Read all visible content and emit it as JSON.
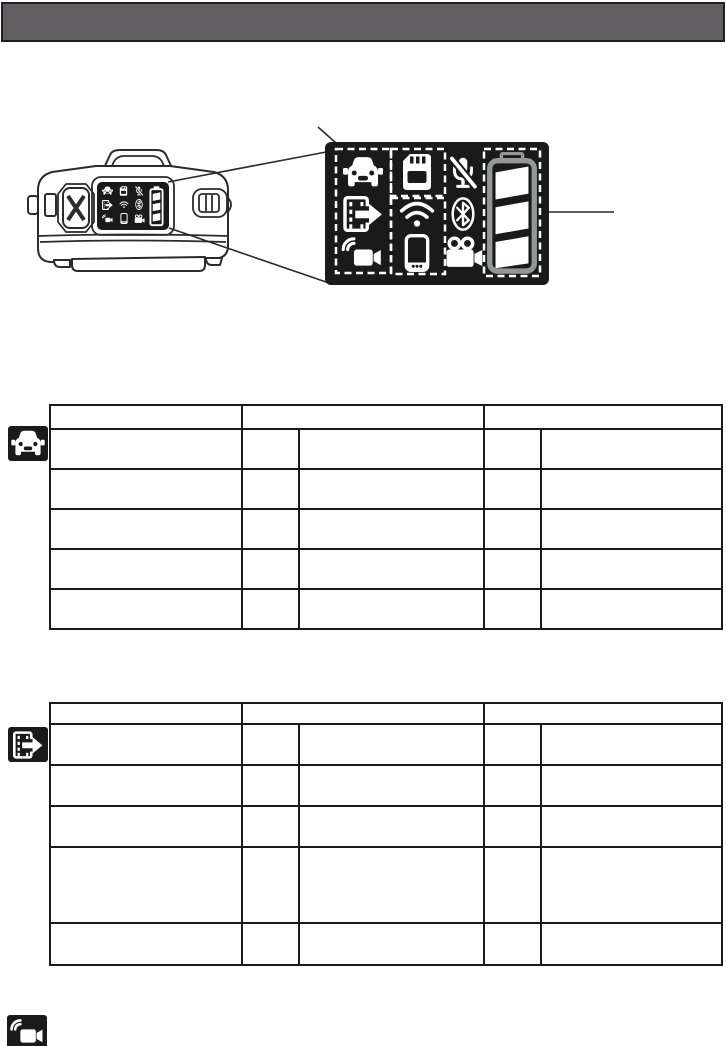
{
  "page": {
    "width": 726,
    "height": 1046,
    "background": "#ffffff",
    "visible_text": ""
  },
  "colors": {
    "page_bg": "#ffffff",
    "header_bar": "#615f62",
    "ink": "#231f20",
    "line": "#2b2b2b",
    "panel_bg": "#1a1a1a",
    "icon_white": "#ffffff",
    "battery_outline": "#949699",
    "table_border": "#1a1a1a"
  },
  "header": {
    "title": "",
    "type": "solid-gray-title-bar"
  },
  "figure": {
    "description_icons": [
      "car-icon",
      "sd-card-icon",
      "mic-mute-icon",
      "movie-export-icon",
      "wifi-icon",
      "bluetooth-icon",
      "wireless-camera-icon",
      "smartphone-icon",
      "movie-camera-icon",
      "battery-icon"
    ],
    "dashed_highlight_groups": [
      "car-movieexport-wirelesscam-column",
      "sd-card-box",
      "wifi-phone-box",
      "battery-box"
    ],
    "battery": {
      "segments_total": 3,
      "segments_filled": 3
    },
    "callouts": {
      "display_to_panel_lines": 2,
      "battery_pointer_line": 1
    }
  },
  "tables": [
    {
      "id": "table-1",
      "icon": "car-icon",
      "left": 49,
      "top": 404,
      "col_widths": [
        192,
        57,
        185,
        57,
        181
      ],
      "header": {
        "height": 24,
        "cells": [
          {
            "span": 1,
            "text": ""
          },
          {
            "span": 2,
            "text": ""
          },
          {
            "span": 2,
            "text": ""
          }
        ]
      },
      "rows": [
        {
          "height": 40,
          "cells": [
            "",
            "",
            "",
            "",
            ""
          ]
        },
        {
          "height": 40,
          "cells": [
            "",
            "",
            "",
            "",
            ""
          ]
        },
        {
          "height": 40,
          "cells": [
            "",
            "",
            "",
            "",
            ""
          ]
        },
        {
          "height": 40,
          "cells": [
            "",
            "",
            "",
            "",
            ""
          ]
        },
        {
          "height": 40,
          "cells": [
            "",
            "",
            "",
            "",
            ""
          ]
        }
      ]
    },
    {
      "id": "table-2",
      "icon": "movie-export-icon",
      "left": 49,
      "top": 702,
      "col_widths": [
        192,
        57,
        185,
        57,
        181
      ],
      "header": {
        "height": 21,
        "cells": [
          {
            "span": 1,
            "text": ""
          },
          {
            "span": 2,
            "text": ""
          },
          {
            "span": 2,
            "text": ""
          }
        ]
      },
      "rows": [
        {
          "height": 41,
          "cells": [
            "",
            "",
            "",
            "",
            ""
          ]
        },
        {
          "height": 41,
          "cells": [
            "",
            "",
            "",
            "",
            ""
          ]
        },
        {
          "height": 41,
          "cells": [
            "",
            "",
            "",
            "",
            ""
          ]
        },
        {
          "height": 76,
          "cells": [
            "",
            "",
            "",
            "",
            ""
          ]
        },
        {
          "height": 42,
          "cells": [
            "",
            "",
            "",
            "",
            ""
          ]
        }
      ]
    }
  ],
  "badges": [
    {
      "name": "car-icon",
      "left": 8,
      "top": 426,
      "width": 40,
      "height": 35
    },
    {
      "name": "movie-export-icon",
      "left": 8,
      "top": 727,
      "width": 40,
      "height": 35
    },
    {
      "name": "wireless-camera-icon",
      "left": 7,
      "top": 1015,
      "width": 40,
      "height": 35
    }
  ]
}
